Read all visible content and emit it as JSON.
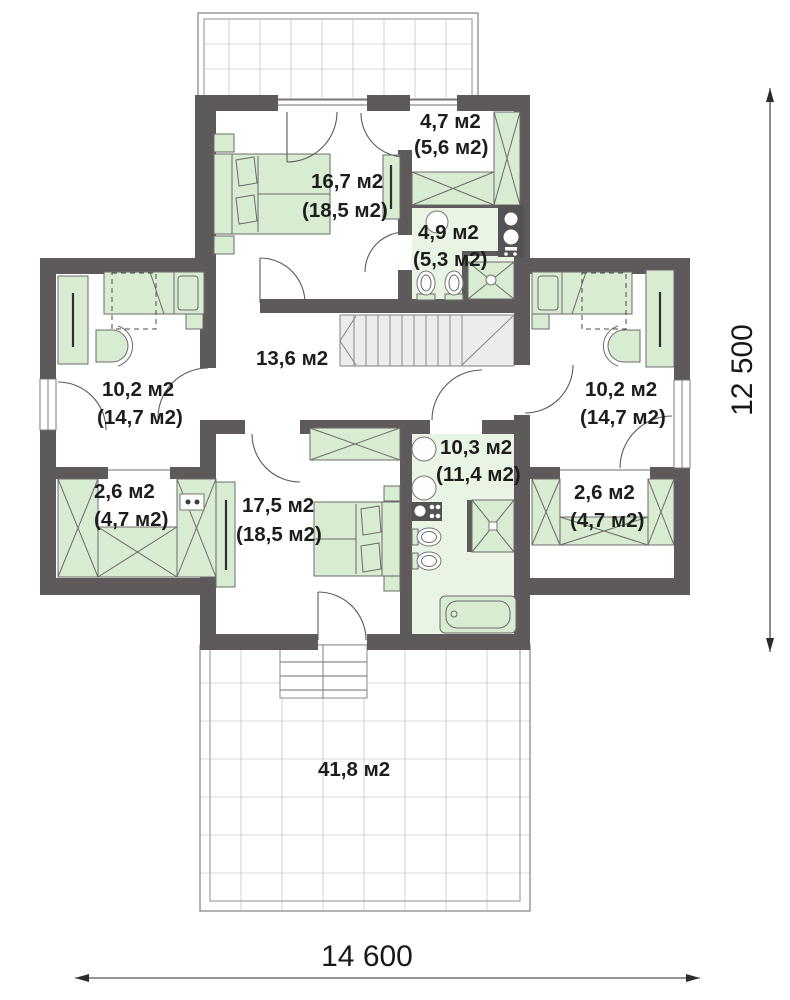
{
  "rooms": {
    "bedroom_top": {
      "area": "16,7 м2",
      "total": "(18,5 м2)"
    },
    "wardrobe_top": {
      "area": "4,7 м2",
      "total": "(5,6 м2)"
    },
    "bath_top": {
      "area": "4,9 м2",
      "total": "(5,3 м2)"
    },
    "hall": {
      "area": "13,6 м2"
    },
    "bedroom_left": {
      "area": "10,2 м2",
      "total": "(14,7 м2)"
    },
    "bedroom_right": {
      "area": "10,2 м2",
      "total": "(14,7 м2)"
    },
    "closet_left": {
      "area": "2,6 м2",
      "total": "(4,7 м2)"
    },
    "closet_right": {
      "area": "2,6 м2",
      "total": "(4,7 м2)"
    },
    "bedroom_bottom": {
      "area": "17,5 м2",
      "total": "(18,5 м2)"
    },
    "bath_bottom": {
      "area": "10,3 м2",
      "total": "(11,4 м2)"
    },
    "terrace": {
      "area": "41,8 м2"
    }
  },
  "dimensions": {
    "width_mm": "14 600",
    "depth_mm": "12 500"
  },
  "colors": {
    "wall": "#5e5a5b",
    "furniture": "#d8ecd2",
    "bath_floor": "#e9f4e5",
    "stairs": "#ececec"
  }
}
